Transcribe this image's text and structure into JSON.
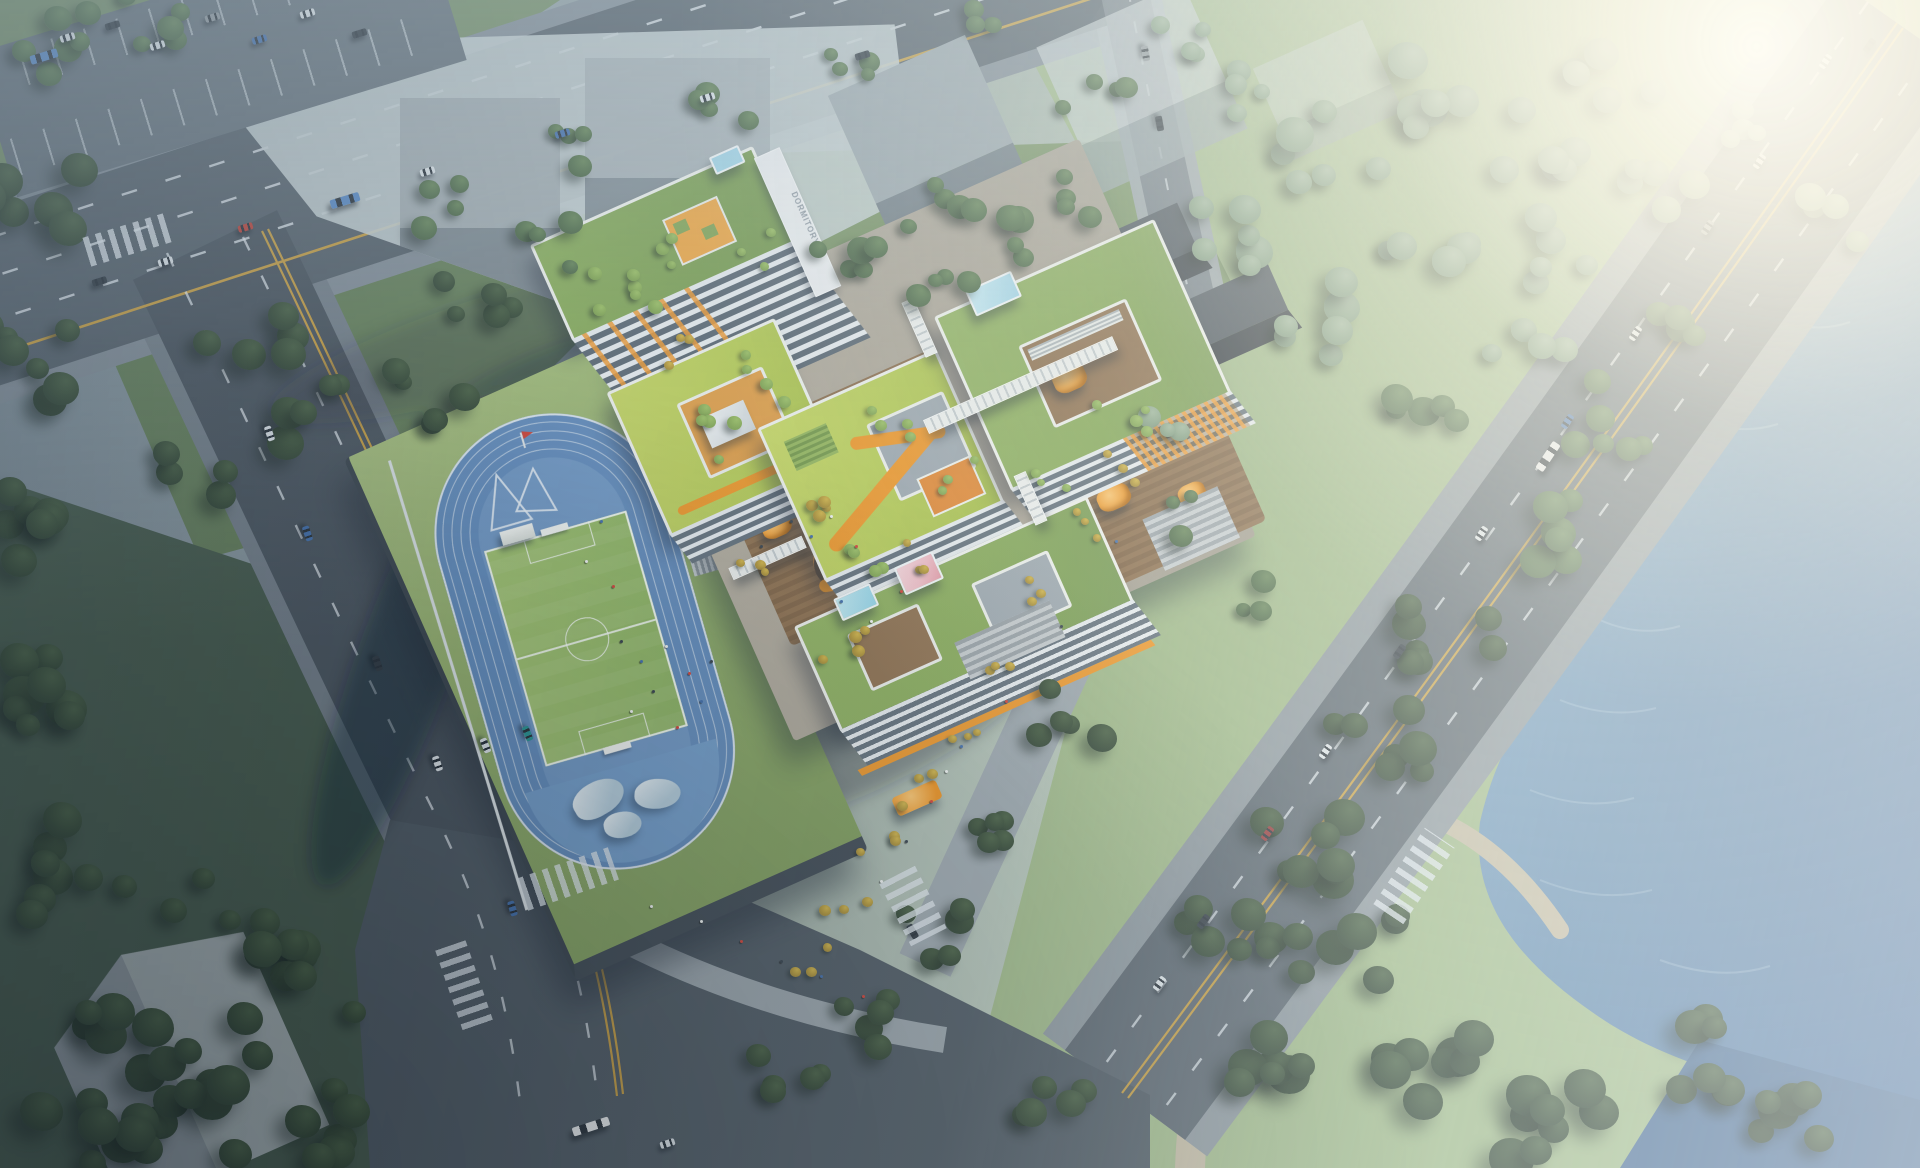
{
  "meta": {
    "kind": "aerial architectural rendering",
    "subject": "green-roof school campus with running track beside a riverside park",
    "lighting": "hazy morning sunlight from the upper right"
  },
  "signage": {
    "dormitory_sign": "DORMITORY"
  },
  "site": {
    "track_lanes": 6
  },
  "palette": {
    "track_blue": "#5d88bb",
    "pitch_green": "#93b95f",
    "roof_lime": "#b4ca4e",
    "roof_grass": "#82a650",
    "accent_orange": "#f0931f",
    "deck_wood": "#85653f",
    "water_blue": "#5b85ad",
    "asphalt": "#4f5a64",
    "ghost_massing": "#c4ced0",
    "forest_dark": "#31462f",
    "flag_red": "#d03a2c",
    "skylight_blue": "#9fd4e8",
    "skylight_pink": "#f2bac4"
  }
}
